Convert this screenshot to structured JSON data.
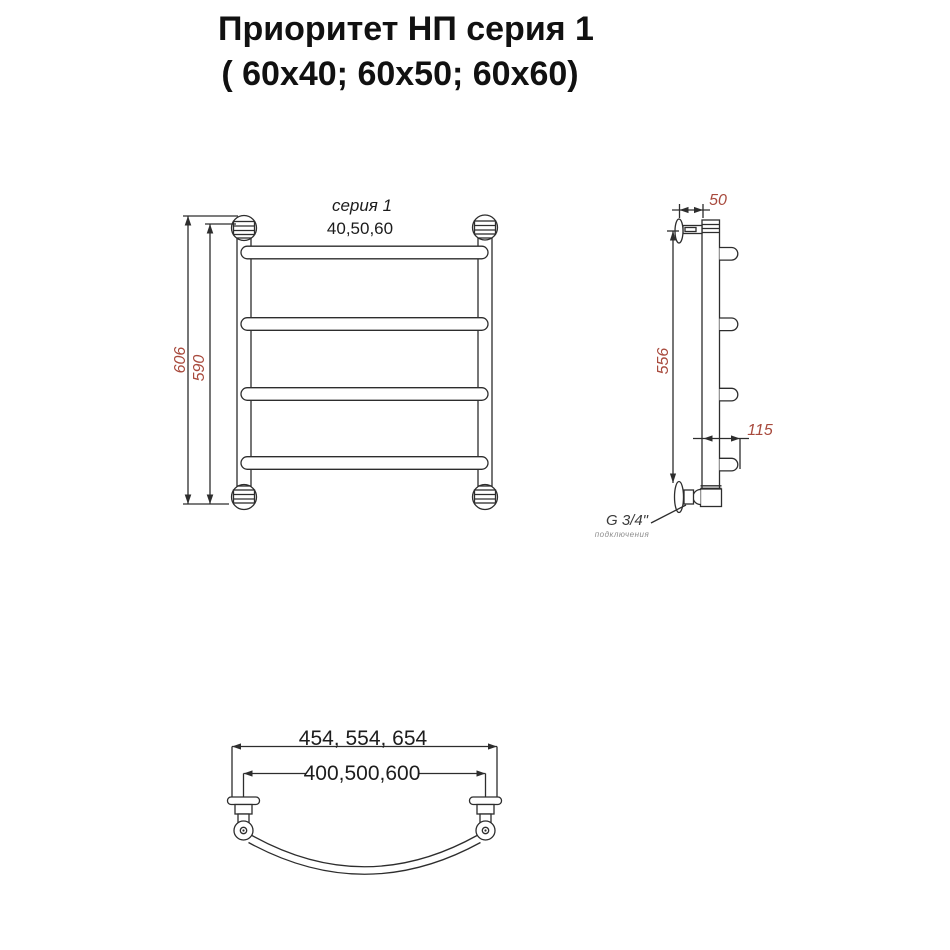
{
  "title": {
    "line1": "Приоритет НП серия 1",
    "line2": "( 60х40; 60х50; 60х60)"
  },
  "front_view": {
    "series_label": "серия 1",
    "width_label": "40,50,60",
    "dim_overall_height": "606",
    "dim_rail_height": "590"
  },
  "side_view": {
    "dim_bracket_depth": "50",
    "dim_mount_height": "556",
    "dim_bar_depth": "115",
    "thread_label": "G 3/4\"",
    "thread_note": "подключения"
  },
  "bottom_view": {
    "dim_outer_width": "454, 554, 654",
    "dim_inner_width": "400,500,600"
  },
  "colors": {
    "line": "#2d2d2d",
    "dimension_red": "#a84a3d",
    "text": "#1c1c1c",
    "note_gray": "#8d8d8d"
  }
}
